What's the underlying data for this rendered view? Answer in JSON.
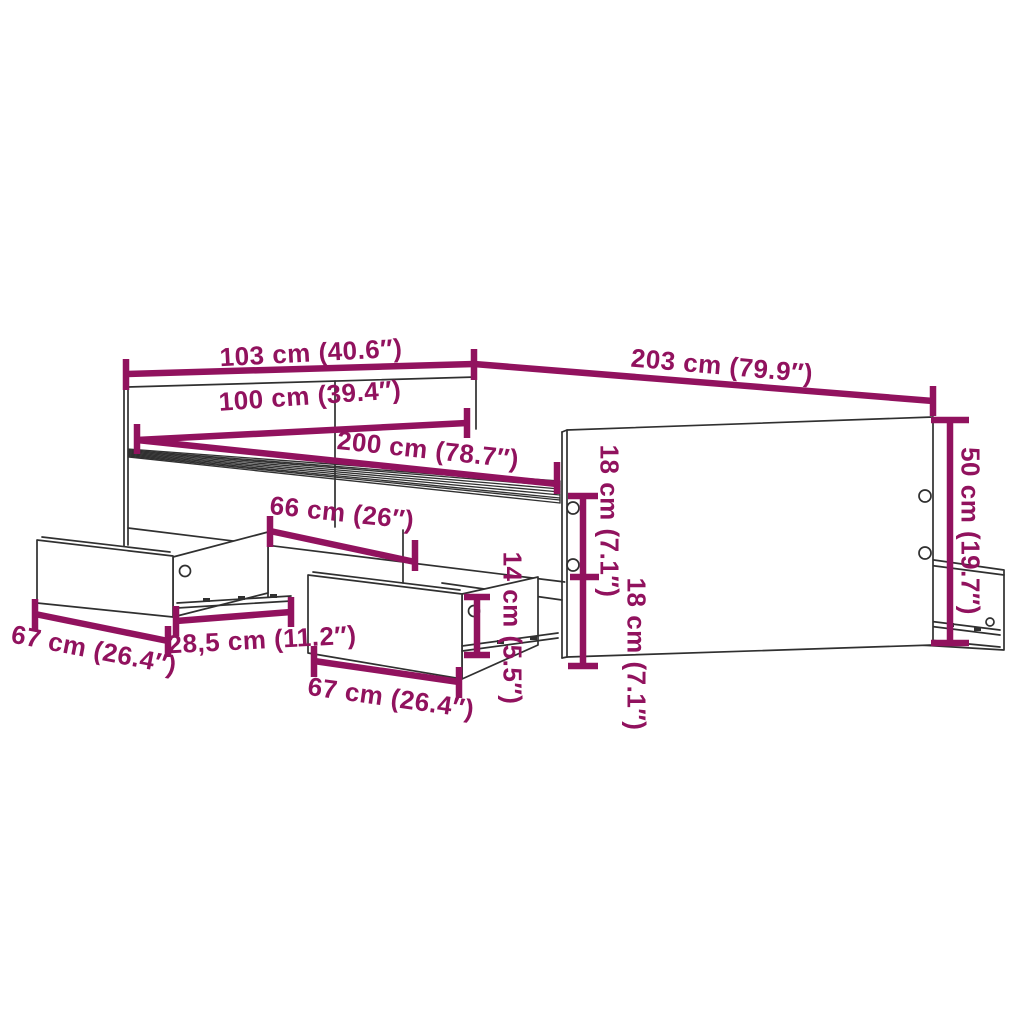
{
  "diagram": {
    "kind": "furniture dimension line drawing",
    "subject": "bed frame with storage drawers",
    "accent_color": "#91125e",
    "outline_color": "#303030",
    "background_color": "#ffffff",
    "dimensions": [
      {
        "id": "headboard-outer-width",
        "label": "103 cm (40.6″)"
      },
      {
        "id": "outer-length",
        "label": "203 cm (79.9″)"
      },
      {
        "id": "inner-width",
        "label": "100 cm (39.4″)"
      },
      {
        "id": "inner-length",
        "label": "200 cm (78.7″)"
      },
      {
        "id": "drawer-bay-width",
        "label": "66 cm (26″)"
      },
      {
        "id": "upper-side-height",
        "label": "18 cm (7.1″)"
      },
      {
        "id": "lower-side-height",
        "label": "18 cm (7.1″)"
      },
      {
        "id": "side-panel-height",
        "label": "50 cm (19.7″)"
      },
      {
        "id": "drawer-front-height",
        "label": "14 cm (5.5″)"
      },
      {
        "id": "left-drawer-width",
        "label": "67 cm (26.4″)"
      },
      {
        "id": "drawer-pullout-gap",
        "label": "28,5 cm (11.2″)"
      },
      {
        "id": "middle-drawer-width",
        "label": "67 cm (26.4″)"
      }
    ]
  }
}
